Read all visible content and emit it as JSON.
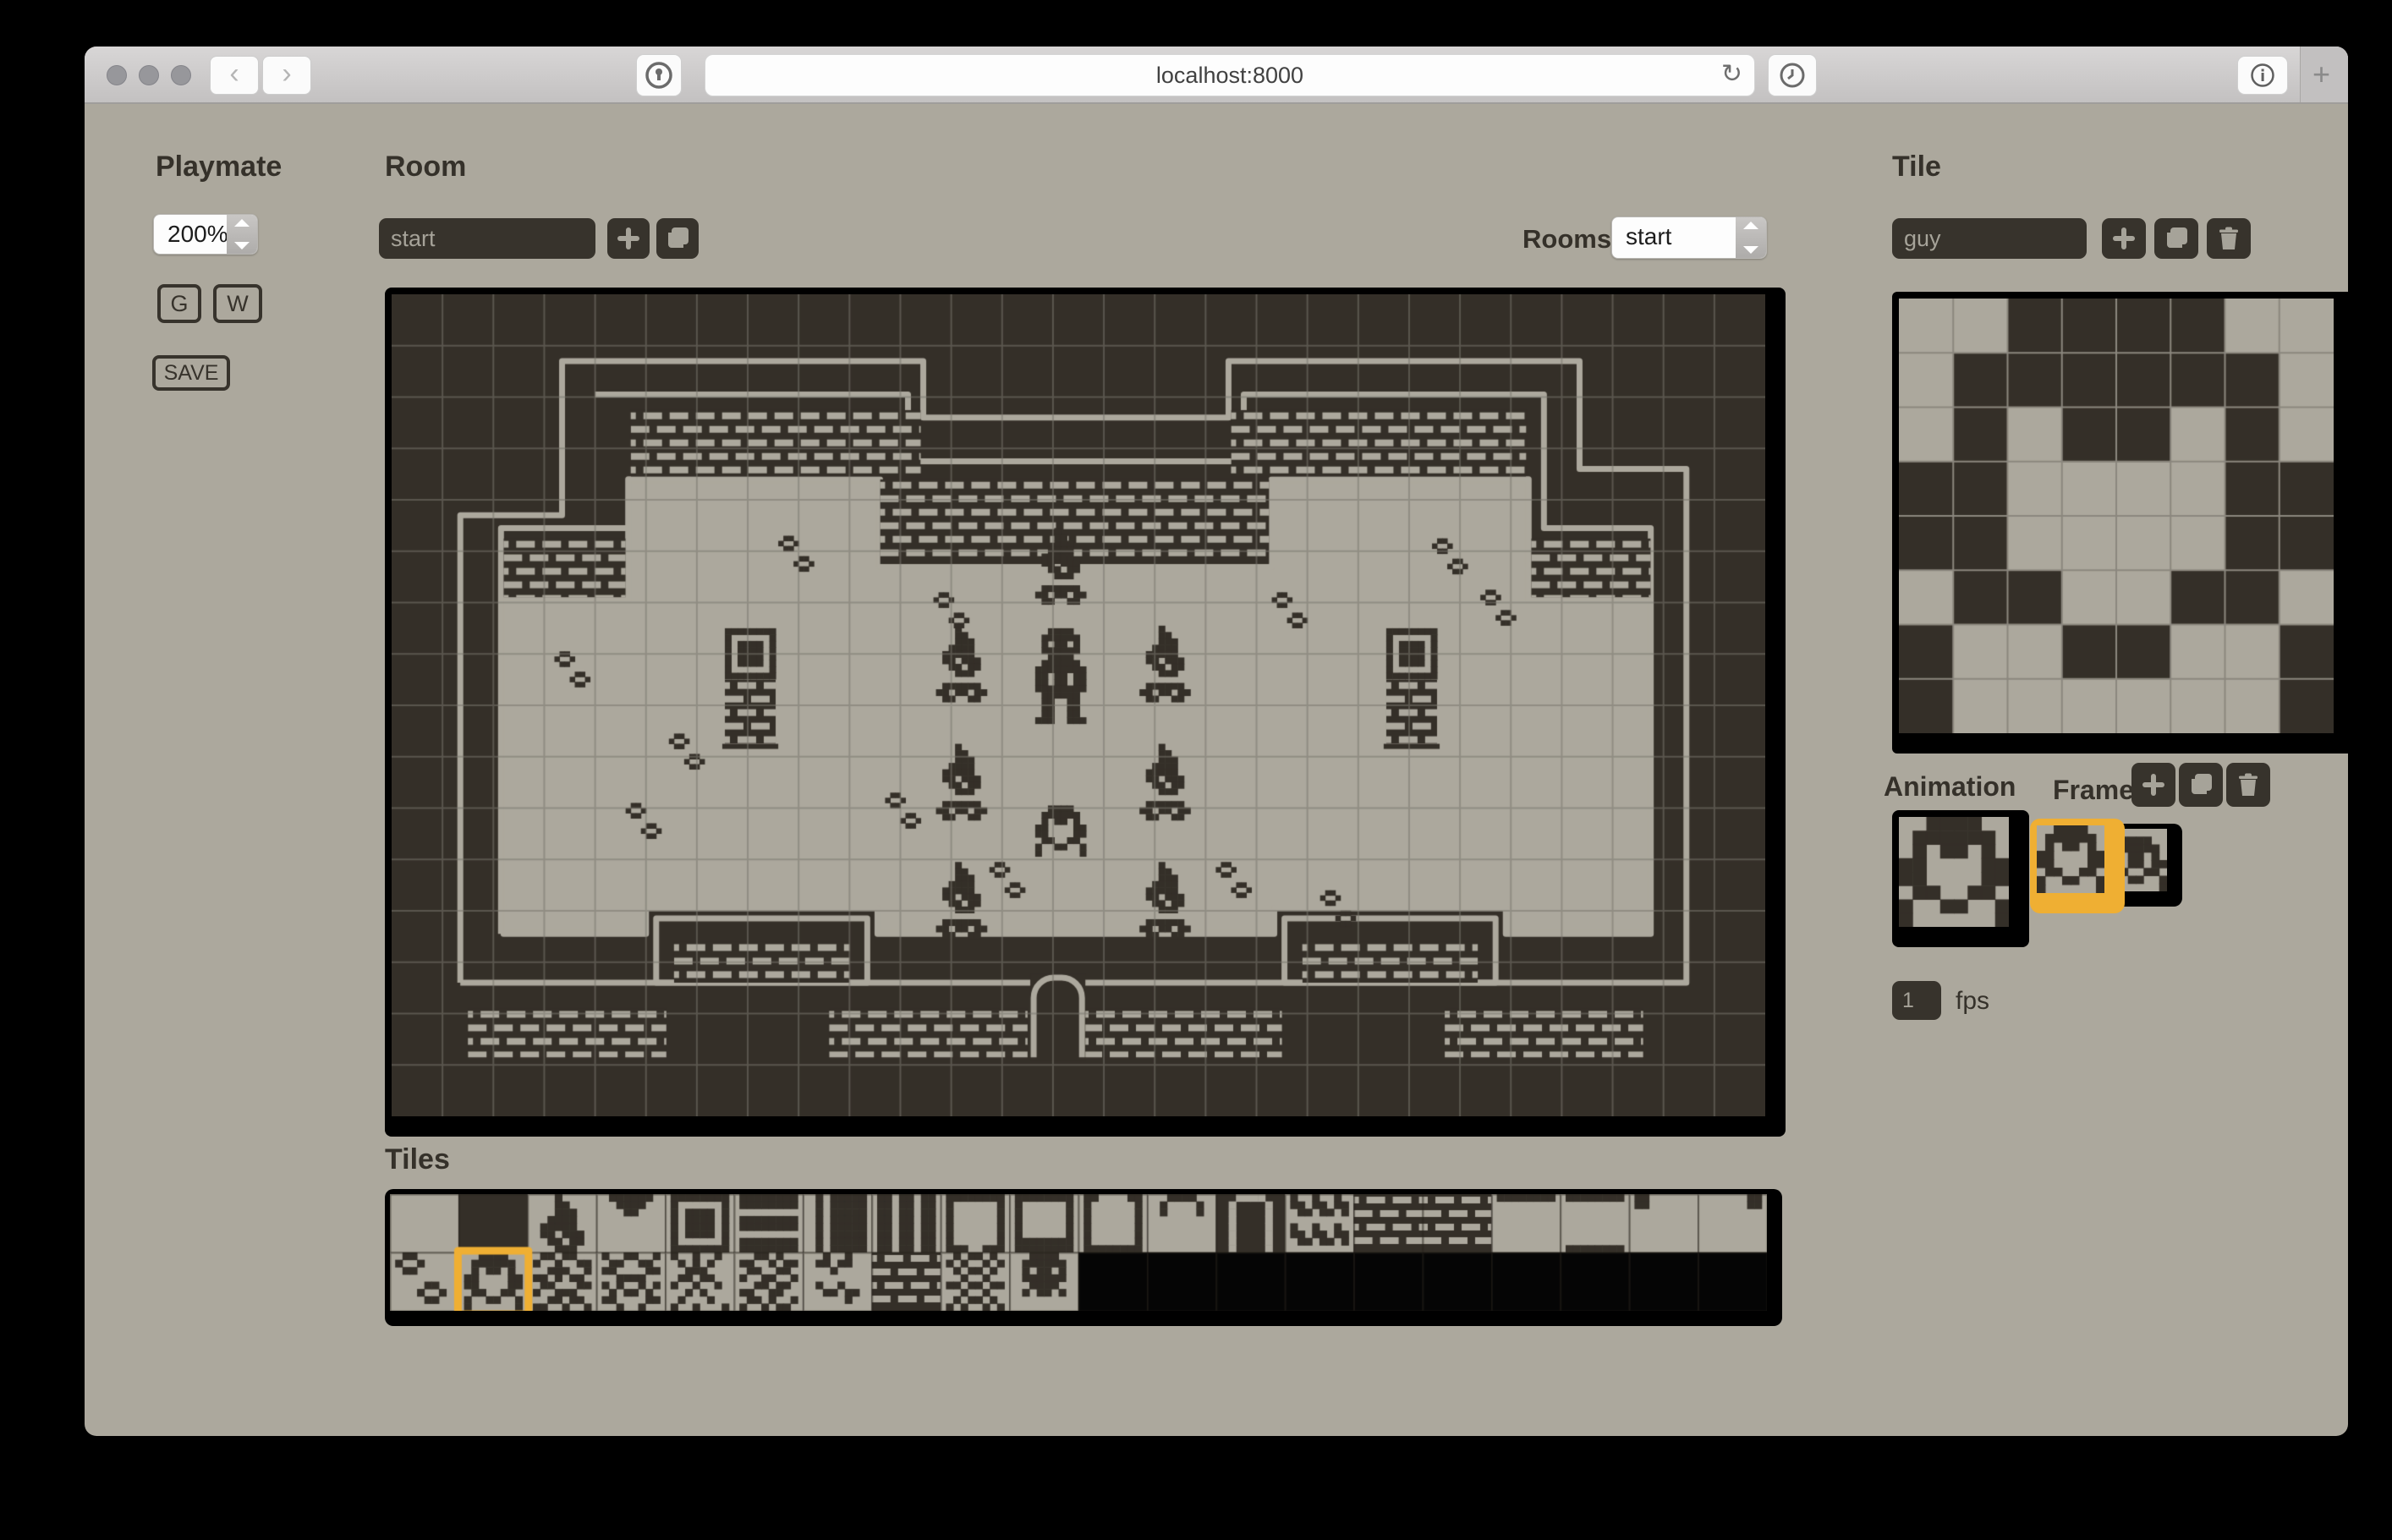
{
  "browser": {
    "url": "localhost:8000",
    "icons": {
      "back": "‹",
      "forward": "›",
      "reload": "↻",
      "plus": "+"
    }
  },
  "sidebar": {
    "title": "Playmate",
    "zoom_value": "200%",
    "grid_button": "G",
    "walls_button": "W",
    "save_button": "SAVE"
  },
  "room_panel": {
    "title": "Room",
    "name_value": "start",
    "rooms_label": "Rooms",
    "rooms_value": "start"
  },
  "tiles_panel": {
    "title": "Tiles"
  },
  "tile_panel": {
    "title": "Tile",
    "name_value": "guy"
  },
  "animation_panel": {
    "title": "Animation",
    "frames_label": "Frames",
    "fps_value": "1",
    "fps_label": "fps"
  },
  "colors": {
    "ink": "#342F28",
    "light": "#ACA89D",
    "black": "#050505",
    "orange": "#EFAF33",
    "grid": "rgba(122,118,110,0.55)",
    "editor_grid": "#8B877E"
  },
  "bitmaps": {
    "guy": [
      "00111100",
      "01111110",
      "01011010",
      "11000011",
      "11000011",
      "01100110",
      "10011001",
      "10000001"
    ],
    "guy2": [
      "00000000",
      "00111100",
      "01111110",
      "01011010",
      "11011011",
      "01100110",
      "10011001",
      "10000001"
    ],
    "torch8": [
      "00010000",
      "00011000",
      "00011100",
      "00111100",
      "01111100",
      "01101110",
      "00110110",
      "00011100"
    ],
    "torch14": [
      "00010000",
      "00011000",
      "00011100",
      "00111100",
      "01111100",
      "01101110",
      "00110110",
      "00011100",
      "00000000",
      "01111110",
      "11011011",
      "01100110",
      "00000000",
      "00000000"
    ],
    "statue": [
      "00111100",
      "01111110",
      "01011010",
      "01111110",
      "00111100",
      "01111110",
      "11111111",
      "11011011",
      "11011011",
      "11111111",
      "01111110",
      "01100110",
      "01100110",
      "01100110",
      "11100111",
      "00000000"
    ],
    "window": [
      "11111111",
      "10000001",
      "10111101",
      "10111101",
      "10111101",
      "10111101",
      "10000001",
      "11111111"
    ],
    "notch": [
      "01111110",
      "00111100",
      "00011000",
      "00000000",
      "00000000",
      "00000000",
      "00000000",
      "00000000"
    ],
    "hlines": [
      "11111111",
      "11111111",
      "00000000",
      "11111111",
      "11111111",
      "00000000",
      "11111111",
      "11111111"
    ],
    "vbar": [
      "01011111",
      "01011111",
      "01011111",
      "01011111",
      "01011111",
      "01011111",
      "01011111",
      "01011111"
    ],
    "vbars": [
      "11011011",
      "11011011",
      "11011011",
      "11011011",
      "11011011",
      "11011011",
      "11011011",
      "11011011"
    ],
    "bigsq": [
      "11111111",
      "10000001",
      "10000001",
      "10000001",
      "10000001",
      "10000001",
      "10000001",
      "11100111"
    ],
    "box": [
      "11111111",
      "10000001",
      "10000001",
      "10000001",
      "10000001",
      "10000001",
      "11111111",
      "11111111"
    ],
    "ubracket": [
      "11000011",
      "10000001",
      "10000001",
      "10000001",
      "10000001",
      "10000001",
      "10000001",
      "11111111"
    ],
    "arch": [
      "00111100",
      "01000010",
      "01000010",
      "00000000",
      "00000000",
      "00000000",
      "00000000",
      "00000000"
    ],
    "doorL": [
      "00111100",
      "01000010",
      "01000010",
      "01000010",
      "01000010",
      "01000010",
      "01000010",
      "01000010"
    ],
    "zigzag": [
      "10010010",
      "11011011",
      "01101101",
      "00000000",
      "10010010",
      "11011011",
      "01101101",
      "00000000"
    ],
    "edge_t": [
      "11111111",
      "00000000",
      "00000000",
      "00000000",
      "00000000",
      "00000000",
      "00000000",
      "00000000"
    ],
    "edge_tb": [
      "11111111",
      "00000000",
      "00000000",
      "00000000",
      "00000000",
      "00000000",
      "00000000",
      "11111111"
    ],
    "edge_dtl": [
      "11000000",
      "11000000",
      "00000000",
      "00000000",
      "00000000",
      "00000000",
      "00000000",
      "00000000"
    ],
    "edge_dtr": [
      "00000011",
      "00000011",
      "00000000",
      "00000000",
      "00000000",
      "00000000",
      "00000000",
      "00000000"
    ],
    "dots": [
      "01100000",
      "10010000",
      "01100000",
      "00000000",
      "00001100",
      "00010010",
      "00001100",
      "00000000"
    ],
    "noise1": [
      "01101100",
      "10010011",
      "00111001",
      "11010110",
      "01100011",
      "10011100",
      "00110110",
      "11001001"
    ],
    "noise2": [
      "10011001",
      "01100110",
      "11000011",
      "00111100",
      "10100101",
      "01011010",
      "11000011",
      "00100100"
    ],
    "vines": [
      "10010010",
      "01010100",
      "00111000",
      "01101100",
      "10010010",
      "00101000",
      "01000100",
      "10010001"
    ],
    "noise3": [
      "00110100",
      "11001011",
      "01100110",
      "10011001",
      "00110110",
      "11001100",
      "01101001",
      "10010110"
    ],
    "marks": [
      "00100100",
      "01101100",
      "00010000",
      "00000000",
      "01001000",
      "00110110",
      "00000100",
      "00000000"
    ],
    "noise4": [
      "01011010",
      "10100101",
      "01011010",
      "00100100",
      "11011011",
      "00100100",
      "01011010",
      "10100101"
    ],
    "skull": [
      "00111100",
      "01111110",
      "01011010",
      "01111110",
      "00111100",
      "01011010",
      "00000000",
      "00000000"
    ]
  },
  "room": {
    "cols": 27,
    "rows": 16,
    "floor": [
      [
        2.2,
        12.45
      ],
      [
        2.2,
        5.95
      ],
      [
        4.65,
        5.95
      ],
      [
        4.65,
        3.6
      ],
      [
        9.6,
        3.6
      ],
      [
        9.6,
        5.3
      ],
      [
        17.3,
        5.3
      ],
      [
        17.3,
        3.6
      ],
      [
        22.35,
        3.6
      ],
      [
        22.35,
        5.95
      ],
      [
        24.75,
        5.95
      ],
      [
        24.75,
        12.45
      ],
      [
        21.9,
        12.45
      ],
      [
        21.9,
        11.95
      ],
      [
        17.35,
        11.95
      ],
      [
        17.35,
        12.45
      ],
      [
        9.55,
        12.45
      ],
      [
        9.55,
        11.95
      ],
      [
        5.0,
        11.95
      ],
      [
        5.0,
        12.45
      ]
    ],
    "outer": [
      [
        1.35,
        13.4
      ],
      [
        1.35,
        4.3
      ],
      [
        3.35,
        4.3
      ],
      [
        3.35,
        1.3
      ],
      [
        10.45,
        1.3
      ],
      [
        10.45,
        2.4
      ],
      [
        16.45,
        2.4
      ],
      [
        16.45,
        1.3
      ],
      [
        23.35,
        1.3
      ],
      [
        23.35,
        3.4
      ],
      [
        25.45,
        3.4
      ],
      [
        25.45,
        13.4
      ],
      [
        1.35,
        13.4
      ]
    ],
    "echoes": [
      [
        [
          4.0,
          1.95
        ],
        [
          10.15,
          1.95
        ],
        [
          10.15,
          3.25
        ],
        [
          16.75,
          3.25
        ],
        [
          16.75,
          1.95
        ],
        [
          22.65,
          1.95
        ],
        [
          22.65,
          4.55
        ],
        [
          24.75,
          4.55
        ],
        [
          24.75,
          5.95
        ]
      ],
      [
        [
          4.65,
          4.55
        ],
        [
          2.15,
          4.55
        ],
        [
          2.15,
          12.45
        ]
      ]
    ],
    "bricks": [
      [
        4.7,
        2.25,
        5.7,
        1.3
      ],
      [
        16.5,
        2.25,
        5.8,
        1.3
      ],
      [
        9.6,
        3.6,
        7.65,
        1.65
      ],
      [
        2.2,
        4.75,
        2.4,
        1.15
      ],
      [
        22.4,
        4.75,
        2.35,
        1.15
      ],
      [
        1.5,
        13.9,
        3.9,
        0.95
      ],
      [
        8.6,
        13.9,
        3.9,
        0.95
      ],
      [
        13.6,
        13.9,
        3.9,
        0.95
      ],
      [
        20.7,
        13.9,
        3.9,
        0.95
      ]
    ],
    "pocket_frames": [
      [
        5.2,
        12.15,
        4.15,
        1.25
      ],
      [
        17.55,
        12.15,
        4.15,
        1.25
      ]
    ],
    "pocket_bricks": [
      [
        5.55,
        12.6,
        3.45,
        0.8
      ],
      [
        17.9,
        12.6,
        3.45,
        0.8
      ]
    ],
    "door": [
      12.62,
      13.3,
      0.95,
      1.55
    ],
    "torches": [
      [
        12.65,
        4.55
      ],
      [
        10.7,
        6.45
      ],
      [
        14.7,
        6.45
      ],
      [
        10.7,
        8.75
      ],
      [
        14.7,
        8.75
      ],
      [
        10.7,
        11.05
      ],
      [
        14.7,
        11.05
      ]
    ],
    "statue": [
      12.65,
      6.5
    ],
    "guy": [
      12.65,
      9.95
    ],
    "windows": [
      [
        6.55,
        6.5
      ],
      [
        19.55,
        6.5
      ]
    ],
    "footprints": [
      [
        7.6,
        4.7
      ],
      [
        3.2,
        6.95
      ],
      [
        10.65,
        5.8
      ],
      [
        17.3,
        5.8
      ],
      [
        20.45,
        4.75
      ],
      [
        21.4,
        5.75
      ],
      [
        11.75,
        11.05
      ],
      [
        16.2,
        11.05
      ],
      [
        18.25,
        11.6
      ],
      [
        5.45,
        8.55
      ],
      [
        9.7,
        9.7
      ],
      [
        4.6,
        9.9
      ]
    ]
  },
  "tile_editor": {
    "bitmap": "guy"
  },
  "animation": {
    "preview": "guy",
    "frames": [
      "guy",
      "guy2"
    ],
    "selected_frame": 0
  },
  "tiles_strip": {
    "selected_index": 21,
    "cells": [
      {
        "b": "light"
      },
      {
        "b": "ink"
      },
      {
        "b": "light",
        "m": "torch8"
      },
      {
        "b": "light",
        "m": "notch"
      },
      {
        "b": "light",
        "m": "window"
      },
      {
        "b": "light",
        "m": "hlines"
      },
      {
        "b": "light",
        "m": "vbar"
      },
      {
        "b": "light",
        "m": "vbars"
      },
      {
        "b": "light",
        "m": "bigsq"
      },
      {
        "b": "light",
        "m": "box"
      },
      {
        "b": "light",
        "m": "ubracket"
      },
      {
        "b": "light",
        "m": "arch"
      },
      {
        "b": "ink",
        "f": "light",
        "m": "doorL"
      },
      {
        "b": "light",
        "m": "zigzag"
      },
      {
        "b": "brick"
      },
      {
        "b": "brick"
      },
      {
        "b": "light",
        "m": "edge_t"
      },
      {
        "b": "light",
        "m": "edge_tb"
      },
      {
        "b": "light",
        "m": "edge_dtl"
      },
      {
        "b": "light",
        "m": "edge_dtr"
      },
      {
        "b": "light",
        "m": "dots"
      },
      {
        "b": "light",
        "m": "guy"
      },
      {
        "b": "light",
        "m": "noise1"
      },
      {
        "b": "light",
        "m": "noise2"
      },
      {
        "b": "light",
        "m": "vines"
      },
      {
        "b": "light",
        "m": "noise3"
      },
      {
        "b": "light",
        "m": "marks"
      },
      {
        "b": "brick"
      },
      {
        "b": "light",
        "m": "noise4"
      },
      {
        "b": "light",
        "m": "skull"
      },
      {
        "b": "black"
      },
      {
        "b": "black"
      },
      {
        "b": "black"
      },
      {
        "b": "black"
      },
      {
        "b": "black"
      },
      {
        "b": "black"
      },
      {
        "b": "black"
      },
      {
        "b": "black"
      },
      {
        "b": "black"
      },
      {
        "b": "black"
      }
    ]
  }
}
